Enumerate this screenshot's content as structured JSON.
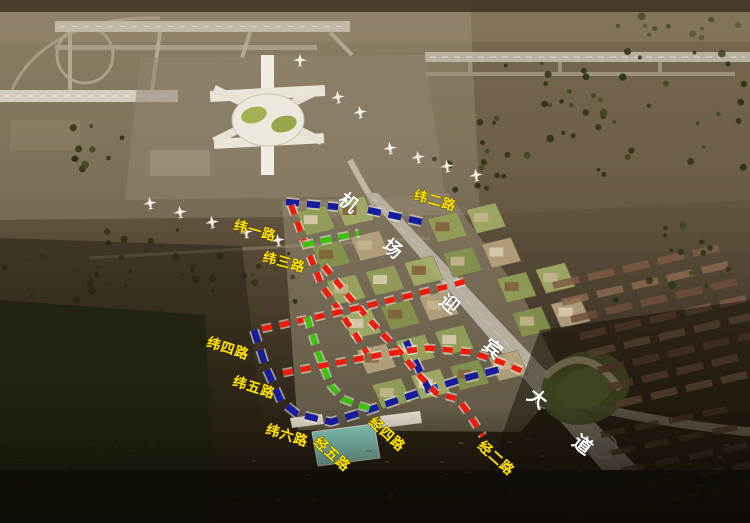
{
  "map": {
    "type": "aerial-rendering",
    "subject": "airport-and-airport-city-road-plan",
    "colors": {
      "blue": "#161c9c",
      "red": "#ee1c0a",
      "green": "#3cc10e",
      "label_yellow": "#ffe604",
      "avenue_text": "#ffffff",
      "halo": "#f4f0e4"
    },
    "road_labels": [
      {
        "name": "label-wei-1-road",
        "text": "纬一路",
        "x": 233,
        "y": 229,
        "rotate": 16
      },
      {
        "name": "label-wei-2-road",
        "text": "纬二路",
        "x": 413,
        "y": 199,
        "rotate": 16
      },
      {
        "name": "label-wei-3-road",
        "text": "纬三路",
        "x": 262,
        "y": 261,
        "rotate": 15
      },
      {
        "name": "label-wei-4-road",
        "text": "纬四路",
        "x": 206,
        "y": 346,
        "rotate": 18
      },
      {
        "name": "label-wei-5-road",
        "text": "纬五路",
        "x": 232,
        "y": 385,
        "rotate": 18
      },
      {
        "name": "label-wei-6-road",
        "text": "纬六路",
        "x": 265,
        "y": 433,
        "rotate": 18
      },
      {
        "name": "label-jing-5-road",
        "text": "经五路",
        "x": 313,
        "y": 443,
        "rotate": 42
      },
      {
        "name": "label-jing-4-road",
        "text": "经四路",
        "x": 368,
        "y": 423,
        "rotate": 42
      },
      {
        "name": "label-jing-2-road",
        "text": "经二路",
        "x": 477,
        "y": 447,
        "rotate": 42
      }
    ],
    "avenue_label": {
      "text": "机场迎宾大道",
      "rotate": 38,
      "chars": [
        {
          "c": "机",
          "x": 337,
          "y": 202
        },
        {
          "c": "场",
          "x": 381,
          "y": 248
        },
        {
          "c": "迎",
          "x": 438,
          "y": 303
        },
        {
          "c": "宾",
          "x": 481,
          "y": 348
        },
        {
          "c": "大",
          "x": 526,
          "y": 398
        },
        {
          "c": "道",
          "x": 571,
          "y": 444
        }
      ]
    },
    "dashed_lines": [
      {
        "name": "line-wei-1-road",
        "color": "blue",
        "points": [
          [
            286,
            202
          ],
          [
            338,
            207
          ]
        ]
      },
      {
        "name": "line-wei-2-road",
        "color": "blue",
        "points": [
          [
            368,
            210
          ],
          [
            422,
            222
          ]
        ]
      },
      {
        "name": "line-boundary-west-south",
        "color": "blue",
        "points": [
          [
            254,
            330
          ],
          [
            266,
            368
          ],
          [
            281,
            401
          ],
          [
            297,
            414
          ],
          [
            331,
            422
          ],
          [
            369,
            410
          ],
          [
            421,
            392
          ],
          [
            466,
            378
          ],
          [
            501,
            369
          ]
        ]
      },
      {
        "name": "line-boundary-east",
        "color": "blue",
        "points": [
          [
            406,
            341
          ],
          [
            417,
            365
          ],
          [
            428,
            388
          ]
        ]
      },
      {
        "name": "line-jing-3-road",
        "color": "red",
        "points": [
          [
            291,
            205
          ],
          [
            306,
            246
          ],
          [
            322,
            286
          ],
          [
            339,
            310
          ],
          [
            355,
            334
          ],
          [
            367,
            353
          ]
        ]
      },
      {
        "name": "line-jing-2-road",
        "color": "red",
        "points": [
          [
            324,
            266
          ],
          [
            350,
            298
          ],
          [
            376,
            327
          ],
          [
            401,
            353
          ],
          [
            420,
            376
          ],
          [
            436,
            393
          ],
          [
            458,
            399
          ],
          [
            469,
            414
          ],
          [
            483,
            436
          ]
        ]
      },
      {
        "name": "line-wei-4-road",
        "color": "red",
        "points": [
          [
            262,
            329
          ],
          [
            312,
            318
          ],
          [
            362,
            307
          ],
          [
            412,
            295
          ],
          [
            453,
            285
          ],
          [
            469,
            280
          ]
        ]
      },
      {
        "name": "line-wei-5-road",
        "color": "red",
        "points": [
          [
            283,
            373
          ],
          [
            331,
            364
          ],
          [
            379,
            355
          ],
          [
            428,
            348
          ],
          [
            471,
            352
          ],
          [
            506,
            364
          ],
          [
            524,
            372
          ]
        ]
      },
      {
        "name": "line-wei-3-road",
        "color": "green",
        "points": [
          [
            303,
            245
          ],
          [
            331,
            239
          ],
          [
            359,
            233
          ]
        ]
      },
      {
        "name": "line-jing-4-road",
        "color": "green",
        "points": [
          [
            307,
            317
          ],
          [
            318,
            353
          ],
          [
            331,
            386
          ],
          [
            343,
            399
          ],
          [
            361,
            406
          ],
          [
            372,
            409
          ]
        ]
      }
    ]
  }
}
